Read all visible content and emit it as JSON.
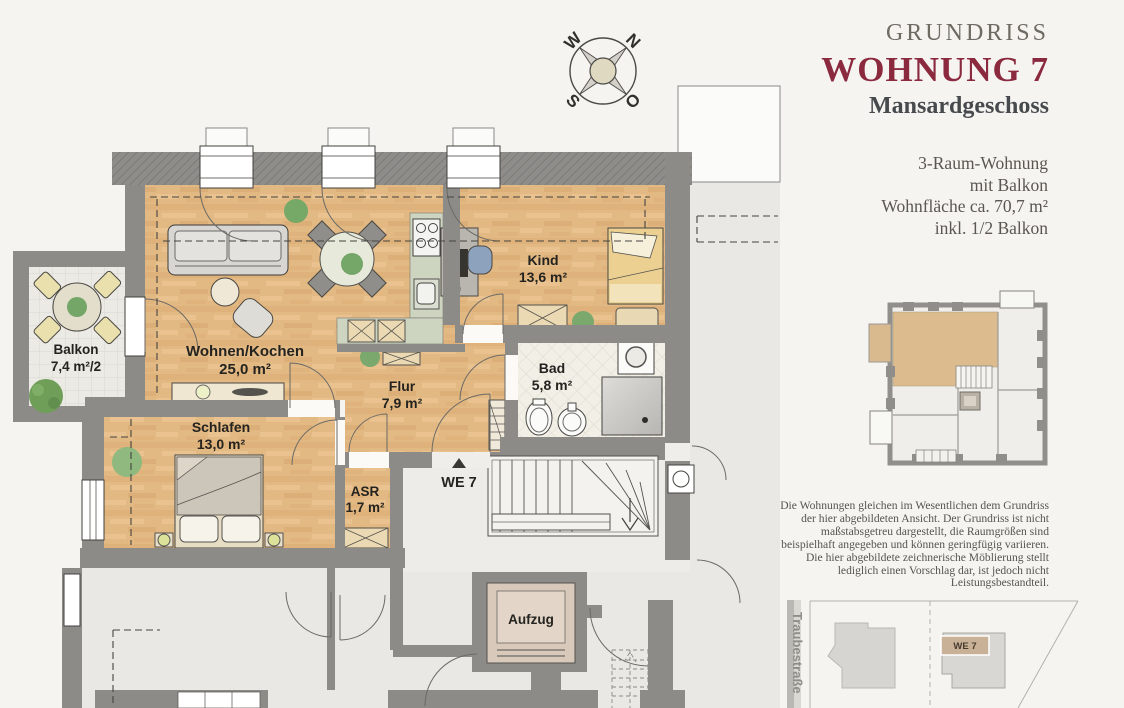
{
  "header": {
    "eyebrow": "GRUNDRISS",
    "title": "WOHNUNG 7",
    "subtitle": "Mansardgeschoss",
    "details": {
      "line1": "3-Raum-Wohnung",
      "line2": "mit Balkon",
      "line3": "Wohnfläche ca. 70,7 m²",
      "line4": "inkl. 1/2 Balkon"
    }
  },
  "compass": {
    "north": "N",
    "east": "O",
    "south": "S",
    "west": "W"
  },
  "rooms": {
    "balkon": {
      "name": "Balkon",
      "area": "7,4 m²/2"
    },
    "wohnen_kochen": {
      "name": "Wohnen/Kochen",
      "area": "25,0 m²"
    },
    "schlafen": {
      "name": "Schlafen",
      "area": "13,0 m²"
    },
    "flur": {
      "name": "Flur",
      "area": "7,9 m²"
    },
    "kind": {
      "name": "Kind",
      "area": "13,6 m²"
    },
    "bad": {
      "name": "Bad",
      "area": "5,8 m²"
    },
    "asr": {
      "name": "ASR",
      "area": "1,7 m²"
    }
  },
  "plan_labels": {
    "entrance": "WE 7",
    "elevator": "Aufzug"
  },
  "disclaimer": "Die Wohnungen gleichen im Wesentlichen dem Grundriss der hier abgebildeten Ansicht. Der Grundriss ist nicht maßstabsgetreu dargestellt, die Raumgrößen sind beispielhaft angegeben und können geringfügig variieren. Die hier abgebildete zeichnerische Möblierung stellt lediglich einen Vorschlag dar, ist jedoch nicht Leistungsbestandteil.",
  "site_plan": {
    "street": "Traubestraße",
    "unit_label": "WE 7"
  },
  "colors": {
    "accent": "#8b2a3e",
    "wood": "#e2b883",
    "wall": "#8d8b88",
    "highlight_tan": "#d9ba8e"
  }
}
